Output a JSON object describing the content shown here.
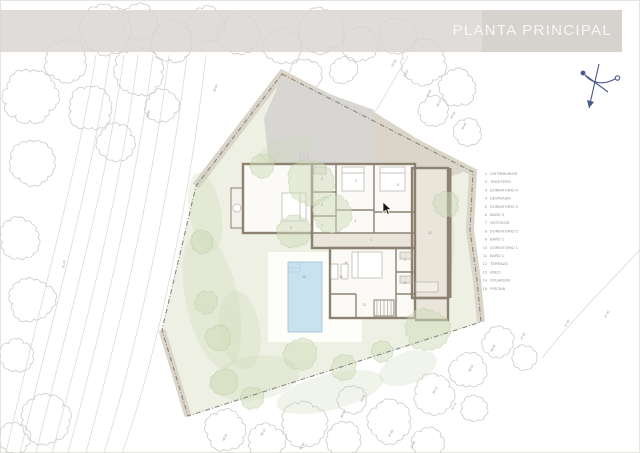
{
  "banner": {
    "title": "PLANTA PRINCIPAL"
  },
  "legend": {
    "items": [
      {
        "num": "1",
        "label": "DISTRIBUIDOR"
      },
      {
        "num": "2",
        "label": "TRASTERO"
      },
      {
        "num": "3",
        "label": "DORMITORIO 4"
      },
      {
        "num": "4",
        "label": "DESPENSA"
      },
      {
        "num": "5",
        "label": "DORMITORIO 3"
      },
      {
        "num": "6",
        "label": "BAÑO 3"
      },
      {
        "num": "7",
        "label": "VESTIDOR"
      },
      {
        "num": "8",
        "label": "DORMITORIO 2"
      },
      {
        "num": "9",
        "label": "BAÑO 2"
      },
      {
        "num": "10",
        "label": "DORMITORIO 1"
      },
      {
        "num": "11",
        "label": "BAÑO 1"
      },
      {
        "num": "12",
        "label": "TERRAZA"
      },
      {
        "num": "13",
        "label": "ASEO"
      },
      {
        "num": "14",
        "label": "SOLARIUM"
      },
      {
        "num": "15",
        "label": "PISCINA"
      }
    ],
    "x_num": 487,
    "x_label": 490,
    "y_start": 175,
    "y_step": 8.2
  },
  "plan": {
    "room_labels": [
      {
        "n": "1",
        "x": 371,
        "y": 241
      },
      {
        "n": "2",
        "x": 322,
        "y": 180
      },
      {
        "n": "3",
        "x": 356,
        "y": 182
      },
      {
        "n": "4",
        "x": 355,
        "y": 222
      },
      {
        "n": "5",
        "x": 291,
        "y": 229
      },
      {
        "n": "6",
        "x": 322,
        "y": 206
      },
      {
        "n": "7",
        "x": 322,
        "y": 227
      },
      {
        "n": "8",
        "x": 398,
        "y": 186
      },
      {
        "n": "9",
        "x": 405,
        "y": 261
      },
      {
        "n": "10",
        "x": 346,
        "y": 264
      },
      {
        "n": "11",
        "x": 405,
        "y": 284
      },
      {
        "n": "12",
        "x": 430,
        "y": 234
      },
      {
        "n": "13",
        "x": 364,
        "y": 306
      },
      {
        "n": "14",
        "x": 341,
        "y": 278
      },
      {
        "n": "15",
        "x": 304,
        "y": 278
      }
    ],
    "site_labels": [
      {
        "t": "50.80",
        "x": 148,
        "y": 118,
        "r": -72
      },
      {
        "t": "51.20",
        "x": 64,
        "y": 268,
        "r": -78
      },
      {
        "t": "50.60",
        "x": 215,
        "y": 92,
        "r": -68
      },
      {
        "t": "50.30",
        "x": 393,
        "y": 67,
        "r": -62
      },
      {
        "t": "50.10",
        "x": 405,
        "y": 77,
        "r": -62
      },
      {
        "t": "49.80",
        "x": 428,
        "y": 97,
        "r": -62
      },
      {
        "t": "49.70",
        "x": 438,
        "y": 107,
        "r": -62
      },
      {
        "t": "49.50",
        "x": 452,
        "y": 119,
        "r": -62
      },
      {
        "t": "49.40",
        "x": 463,
        "y": 130,
        "r": -62
      },
      {
        "t": "48.20",
        "x": 224,
        "y": 441,
        "r": -62
      },
      {
        "t": "48.10",
        "x": 262,
        "y": 436,
        "r": -62
      },
      {
        "t": "47.90",
        "x": 301,
        "y": 450,
        "r": -62
      },
      {
        "t": "48.40",
        "x": 342,
        "y": 418,
        "r": -62
      },
      {
        "t": "48.00",
        "x": 362,
        "y": 402,
        "r": -62
      },
      {
        "t": "47.80",
        "x": 390,
        "y": 437,
        "r": -62
      },
      {
        "t": "47.60",
        "x": 412,
        "y": 448,
        "r": -62
      },
      {
        "t": "48.10",
        "x": 434,
        "y": 394,
        "r": -62
      },
      {
        "t": "47.70",
        "x": 453,
        "y": 410,
        "r": -62
      },
      {
        "t": "48.30",
        "x": 470,
        "y": 372,
        "r": -62
      },
      {
        "t": "48.00",
        "x": 492,
        "y": 352,
        "r": -62
      },
      {
        "t": "47.90",
        "x": 522,
        "y": 340,
        "r": -62
      },
      {
        "t": "47.60",
        "x": 566,
        "y": 327,
        "r": -62
      },
      {
        "t": "47.40",
        "x": 606,
        "y": 318,
        "r": -62
      }
    ],
    "trees": [
      [
        30,
        96,
        27
      ],
      [
        66,
        62,
        21
      ],
      [
        106,
        30,
        25
      ],
      [
        90,
        108,
        22
      ],
      [
        138,
        72,
        24
      ],
      [
        32,
        162,
        22
      ],
      [
        140,
        22,
        18
      ],
      [
        172,
        42,
        20
      ],
      [
        206,
        24,
        18
      ],
      [
        162,
        106,
        16
      ],
      [
        116,
        142,
        18
      ],
      [
        20,
        238,
        20
      ],
      [
        32,
        300,
        22
      ],
      [
        16,
        356,
        16
      ],
      [
        46,
        420,
        24
      ],
      [
        14,
        438,
        15
      ],
      [
        240,
        34,
        20
      ],
      [
        282,
        46,
        18
      ],
      [
        322,
        30,
        22
      ],
      [
        360,
        44,
        17
      ],
      [
        306,
        74,
        15
      ],
      [
        344,
        70,
        13
      ],
      [
        398,
        36,
        18
      ],
      [
        424,
        62,
        22
      ],
      [
        458,
        88,
        18
      ],
      [
        300,
        108,
        13
      ],
      [
        434,
        112,
        15
      ],
      [
        468,
        132,
        13
      ],
      [
        226,
        430,
        20
      ],
      [
        266,
        442,
        18
      ],
      [
        304,
        424,
        22
      ],
      [
        344,
        440,
        17
      ],
      [
        352,
        400,
        14
      ],
      [
        390,
        422,
        21
      ],
      [
        428,
        444,
        16
      ],
      [
        434,
        394,
        19
      ],
      [
        468,
        370,
        17
      ],
      [
        498,
        342,
        15
      ],
      [
        524,
        358,
        12
      ],
      [
        474,
        408,
        13
      ]
    ],
    "green_trees": [
      [
        310,
        182,
        23
      ],
      [
        332,
        214,
        18
      ],
      [
        294,
        232,
        16
      ],
      [
        262,
        166,
        12
      ],
      [
        428,
        330,
        21
      ],
      [
        300,
        354,
        15
      ],
      [
        224,
        382,
        13
      ],
      [
        206,
        302,
        11
      ],
      [
        202,
        242,
        11
      ],
      [
        446,
        204,
        12
      ],
      [
        218,
        338,
        12
      ],
      [
        344,
        368,
        12
      ],
      [
        382,
        352,
        10
      ],
      [
        252,
        398,
        11
      ]
    ],
    "lawn_patches": [
      [
        212,
        300,
        26,
        70,
        -12
      ],
      [
        255,
        378,
        45,
        22,
        -8
      ],
      [
        330,
        392,
        55,
        18,
        -14
      ],
      [
        408,
        368,
        30,
        16,
        -20
      ],
      [
        205,
        212,
        16,
        40,
        -10
      ],
      [
        442,
        252,
        12,
        48,
        4
      ],
      [
        285,
        152,
        30,
        14,
        -20
      ],
      [
        240,
        330,
        20,
        40,
        -10
      ]
    ],
    "contours": [
      "M96,55 C78,170 38,310 6,453",
      "M110,55 C92,180 52,320 20,453",
      "M124,55 C106,190 66,330 36,453",
      "M138,55 C120,198 82,340 52,453",
      "M153,55 C134,204 96,348 68,453",
      "M169,55 C150,210 112,356 86,453",
      "M187,55 C168,214 132,364 104,453",
      "M206,55 C188,216 152,372 122,453",
      "M408,56 L354,148",
      "M640,250 C604,288 570,322 542,358"
    ]
  },
  "colors": {
    "lawn": "#edf0e2",
    "patch": "#c9d8b2",
    "band": "#dbd5c9",
    "boundary": "#8b8781",
    "driveway": "#d8d6d3",
    "wall": "#8d8172",
    "floor": "#e9e5da",
    "room": "#fbfaf6",
    "pool": "#c8e2f0",
    "pool_edge": "#9fbdd0",
    "tree": "#cecbc7",
    "green_fill": "#cfdcba",
    "green_edge": "#b7c9a0",
    "contour": "#dcdad7",
    "label": "#97908a",
    "compass": "#4a568e"
  }
}
